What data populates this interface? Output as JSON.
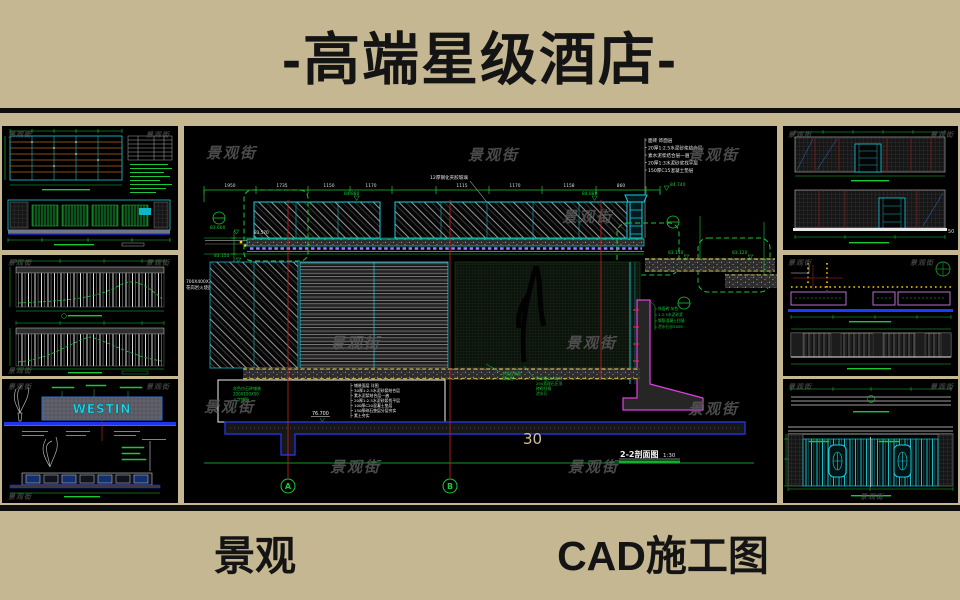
{
  "header": {
    "title": "-高端星级酒店-"
  },
  "footer": {
    "left_label": "景观",
    "right_label": "CAD施工图"
  },
  "watermark": "景观街",
  "colors": {
    "banner_bg": "#c4b791",
    "panel_bg": "#000000",
    "cad_green": "#19c837",
    "cad_cyan": "#19cfe0",
    "cad_magenta": "#e040e0",
    "cad_purple": "#a873ff",
    "cad_yellow": "#e8d44d",
    "cad_blue": "#2233ee",
    "sheet_tan": "#cfc196"
  },
  "center": {
    "sheet_number": "30",
    "view_title": "2-2剖面图",
    "scale": "1:30",
    "grid_a": "A",
    "grid_b": "B",
    "dims_top": [
      "1950",
      "1735",
      "1150",
      "1170",
      "1115",
      "1170",
      "1158",
      "860"
    ],
    "elev_roof_1": "84.880",
    "elev_roof_2": "84.880",
    "elev_cap": "84.740",
    "elev_beam": "83.600",
    "elev_beam2": "83.570",
    "elev_ground_l": "83.150",
    "elev_ground_r": "83.150",
    "elev_ground_r2": "83.120",
    "elev_footing": "76.700",
    "glass_note": "12厚钢化夹胶玻璃",
    "stone_note_1": "700X400X300芝麻灰",
    "stone_note_2": "花岗岩火烧面",
    "roof_layers": [
      "面砖 饰面层",
      "20厚1:2.5水泥砂浆结合层",
      "素水泥浆结合层一遍",
      "20厚1:3水泥砂浆找平层",
      "150厚C15混凝土垫层"
    ],
    "floor_layers": [
      "铺装面层 详图",
      "30厚1:2.5水泥砂浆结合层",
      "素水泥浆结合层一遍",
      "20厚1:2.5水泥砂浆找平层",
      "100厚C20混凝土垫层",
      "150厚碎石垫层分层夯实",
      "素土夯实"
    ],
    "paving_notes": [
      "灰色仿石砖铺装",
      "200X100X50",
      "人字铺贴"
    ],
    "wall_note_a": [
      "水洗石饰面",
      "深灰色"
    ],
    "wall_note_b": [
      "防水层SBS卷材",
      "200宽理石压顶",
      "砖砌挡墙",
      "泄水孔"
    ],
    "retain_notes": [
      "饰面砖 灰色",
      "1:2.5水泥砂浆",
      "钢筋混凝土挡墙",
      "泄水孔@2000"
    ],
    "dim_side_1": "450",
    "dim_side_2": "750"
  },
  "left_col": {
    "sign_text": "WESTIN"
  },
  "right_col": {
    "edge_number": "50"
  }
}
